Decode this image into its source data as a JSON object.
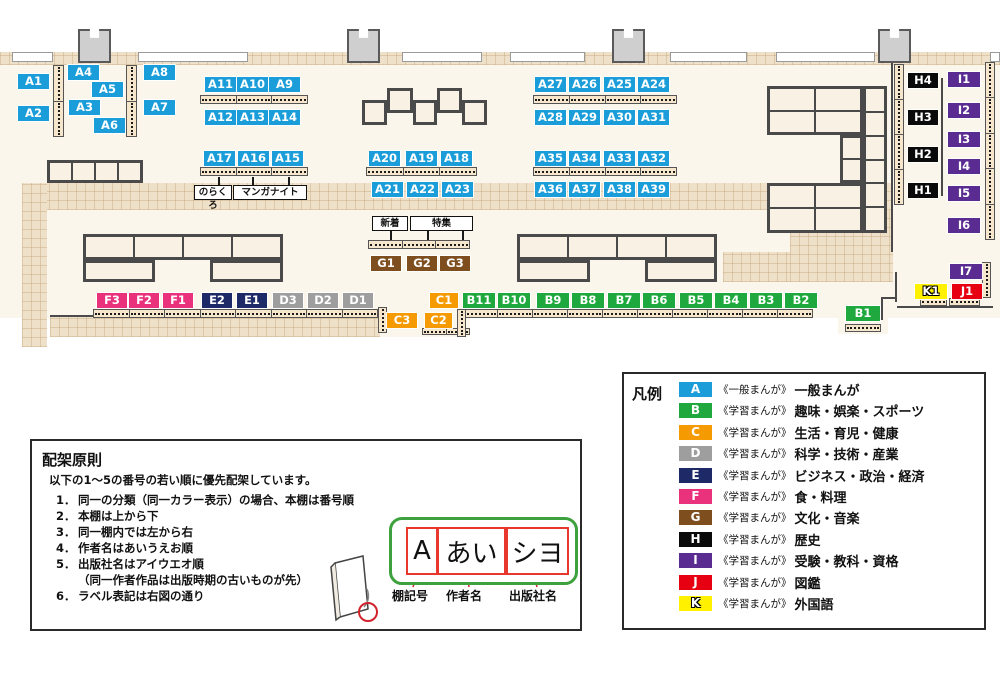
{
  "colors": {
    "A": "#1B9DD9",
    "B": "#1FA83D",
    "C": "#F59A00",
    "D": "#9E9E9F",
    "E": "#1E2A68",
    "F": "#E9317C",
    "G": "#7E4E1F",
    "H": "#0A0A0A",
    "I": "#5A2C91",
    "J": "#E60012",
    "K": "#FFF100"
  },
  "map": {
    "floor": [
      {
        "x": 0,
        "y": 52,
        "w": 1000,
        "h": 266
      },
      {
        "x": 378,
        "y": 318,
        "w": 92,
        "h": 19
      },
      {
        "x": 838,
        "y": 318,
        "w": 50,
        "h": 16
      }
    ],
    "bands": [
      {
        "x": 0,
        "y": 52,
        "w": 1000,
        "h": 13
      },
      {
        "x": 22,
        "y": 183,
        "w": 871,
        "h": 27
      },
      {
        "x": 22,
        "y": 183,
        "w": 25,
        "h": 164
      },
      {
        "x": 50,
        "y": 317,
        "w": 330,
        "h": 20
      },
      {
        "x": 790,
        "y": 210,
        "w": 103,
        "h": 72
      },
      {
        "x": 723,
        "y": 252,
        "w": 67,
        "h": 30
      }
    ],
    "windows": [
      {
        "x": 12,
        "w": 41
      },
      {
        "x": 138,
        "w": 110
      },
      {
        "x": 402,
        "w": 80
      },
      {
        "x": 510,
        "w": 75
      },
      {
        "x": 670,
        "w": 77
      },
      {
        "x": 776,
        "w": 99
      },
      {
        "x": 990,
        "w": 10
      }
    ],
    "pillars": [
      78,
      347,
      612,
      878
    ],
    "lines": [
      {
        "x": 891,
        "y": 62,
        "w": 2,
        "h": 190
      },
      {
        "x": 895,
        "y": 272,
        "w": 2,
        "h": 30
      },
      {
        "x": 881,
        "y": 297,
        "w": 16,
        "h": 2
      },
      {
        "x": 881,
        "y": 297,
        "w": 2,
        "h": 23
      },
      {
        "x": 897,
        "y": 306,
        "w": 96,
        "h": 2
      },
      {
        "x": 50,
        "y": 315,
        "w": 330,
        "h": 2
      },
      {
        "x": 941,
        "y": 78,
        "w": 2,
        "h": 118
      }
    ],
    "tables": [
      {
        "x": 47,
        "y": 160,
        "w": 96,
        "h": 23,
        "cols": 4
      },
      {
        "x": 362,
        "y": 100,
        "w": 25,
        "h": 25
      },
      {
        "x": 387,
        "y": 88,
        "w": 26,
        "h": 25
      },
      {
        "x": 413,
        "y": 100,
        "w": 24,
        "h": 25
      },
      {
        "x": 437,
        "y": 88,
        "w": 25,
        "h": 25
      },
      {
        "x": 462,
        "y": 100,
        "w": 25,
        "h": 25
      },
      {
        "x": 83,
        "y": 234,
        "w": 200,
        "h": 26,
        "cols": 4
      },
      {
        "x": 83,
        "y": 260,
        "w": 72,
        "h": 22
      },
      {
        "x": 210,
        "y": 260,
        "w": 73,
        "h": 22
      },
      {
        "x": 517,
        "y": 234,
        "w": 200,
        "h": 26,
        "cols": 4
      },
      {
        "x": 517,
        "y": 260,
        "w": 73,
        "h": 22
      },
      {
        "x": 645,
        "y": 260,
        "w": 72,
        "h": 22
      },
      {
        "x": 767,
        "y": 86,
        "w": 96,
        "h": 49,
        "cols": 2,
        "rows": 2
      },
      {
        "x": 863,
        "y": 86,
        "w": 24,
        "h": 147,
        "rows": 6
      },
      {
        "x": 840,
        "y": 135,
        "w": 23,
        "h": 48,
        "rows": 2
      },
      {
        "x": 767,
        "y": 183,
        "w": 96,
        "h": 50,
        "cols": 2,
        "rows": 2
      }
    ],
    "strips": [
      {
        "x": 200,
        "y": 95,
        "w": 108,
        "h": 9,
        "seg": 3
      },
      {
        "x": 200,
        "y": 167,
        "w": 108,
        "h": 9,
        "seg": 3
      },
      {
        "x": 366,
        "y": 167,
        "w": 111,
        "h": 9,
        "seg": 3
      },
      {
        "x": 533,
        "y": 95,
        "w": 144,
        "h": 9,
        "seg": 4
      },
      {
        "x": 533,
        "y": 167,
        "w": 144,
        "h": 9,
        "seg": 4
      },
      {
        "x": 368,
        "y": 240,
        "w": 102,
        "h": 9,
        "seg": 3
      },
      {
        "x": 93,
        "y": 309,
        "w": 285,
        "h": 9,
        "seg": 8
      },
      {
        "x": 462,
        "y": 309,
        "w": 351,
        "h": 9,
        "seg": 10
      },
      {
        "x": 845,
        "y": 324,
        "w": 36,
        "h": 8,
        "seg": 1
      },
      {
        "x": 920,
        "y": 298,
        "w": 27,
        "h": 8,
        "seg": 1
      },
      {
        "x": 949,
        "y": 298,
        "w": 31,
        "h": 8,
        "seg": 1
      },
      {
        "x": 422,
        "y": 328,
        "w": 48,
        "h": 7,
        "seg": 2
      },
      {
        "x": 53,
        "y": 65,
        "w": 11,
        "h": 72,
        "seg": 2,
        "o": "v"
      },
      {
        "x": 126,
        "y": 65,
        "w": 11,
        "h": 72,
        "seg": 2,
        "o": "v"
      },
      {
        "x": 894,
        "y": 64,
        "w": 10,
        "h": 141,
        "seg": 4,
        "o": "v"
      },
      {
        "x": 985,
        "y": 62,
        "w": 10,
        "h": 178,
        "seg": 5,
        "o": "v"
      },
      {
        "x": 982,
        "y": 262,
        "w": 9,
        "h": 36,
        "seg": 1,
        "o": "v"
      },
      {
        "x": 378,
        "y": 307,
        "w": 9,
        "h": 26,
        "seg": 1,
        "o": "v"
      },
      {
        "x": 457,
        "y": 309,
        "w": 9,
        "h": 28,
        "seg": 1,
        "o": "v"
      }
    ],
    "callouts": [
      {
        "text": "のらくろ",
        "x": 194,
        "y": 185,
        "w": 38,
        "tails": [
          {
            "x": 218,
            "y1": 177,
            "y2": 185
          }
        ]
      },
      {
        "text": "マンガナイト",
        "x": 233,
        "y": 185,
        "w": 74,
        "tails": [
          {
            "x": 252,
            "y1": 177,
            "y2": 185
          },
          {
            "x": 288,
            "y1": 177,
            "y2": 185
          }
        ]
      },
      {
        "text": "新着",
        "x": 372,
        "y": 216,
        "w": 36,
        "tails": [
          {
            "x": 390,
            "y1": 231,
            "y2": 240
          }
        ]
      },
      {
        "text": "特集",
        "x": 410,
        "y": 216,
        "w": 63,
        "tails": [
          {
            "x": 427,
            "y1": 231,
            "y2": 240
          },
          {
            "x": 462,
            "y1": 231,
            "y2": 240
          }
        ]
      }
    ],
    "labels": [
      {
        "c": "A1",
        "g": "A",
        "x": 18,
        "y": 74
      },
      {
        "c": "A2",
        "g": "A",
        "x": 18,
        "y": 106
      },
      {
        "c": "A4",
        "g": "A",
        "x": 68,
        "y": 65
      },
      {
        "c": "A5",
        "g": "A",
        "x": 92,
        "y": 82
      },
      {
        "c": "A3",
        "g": "A",
        "x": 69,
        "y": 100
      },
      {
        "c": "A6",
        "g": "A",
        "x": 94,
        "y": 118
      },
      {
        "c": "A8",
        "g": "A",
        "x": 144,
        "y": 65
      },
      {
        "c": "A7",
        "g": "A",
        "x": 144,
        "y": 100
      },
      {
        "c": "A11",
        "g": "A",
        "x": 205,
        "y": 77
      },
      {
        "c": "A10",
        "g": "A",
        "x": 237,
        "y": 77
      },
      {
        "c": "A9",
        "g": "A",
        "x": 269,
        "y": 77
      },
      {
        "c": "A12",
        "g": "A",
        "x": 205,
        "y": 110
      },
      {
        "c": "A13",
        "g": "A",
        "x": 237,
        "y": 110
      },
      {
        "c": "A14",
        "g": "A",
        "x": 269,
        "y": 110
      },
      {
        "c": "A17",
        "g": "A",
        "x": 204,
        "y": 151
      },
      {
        "c": "A16",
        "g": "A",
        "x": 238,
        "y": 151
      },
      {
        "c": "A15",
        "g": "A",
        "x": 272,
        "y": 151
      },
      {
        "c": "A20",
        "g": "A",
        "x": 369,
        "y": 151
      },
      {
        "c": "A19",
        "g": "A",
        "x": 406,
        "y": 151
      },
      {
        "c": "A18",
        "g": "A",
        "x": 441,
        "y": 151
      },
      {
        "c": "A21",
        "g": "A",
        "x": 372,
        "y": 182
      },
      {
        "c": "A22",
        "g": "A",
        "x": 407,
        "y": 182
      },
      {
        "c": "A23",
        "g": "A",
        "x": 442,
        "y": 182
      },
      {
        "c": "A27",
        "g": "A",
        "x": 535,
        "y": 77
      },
      {
        "c": "A26",
        "g": "A",
        "x": 569,
        "y": 77
      },
      {
        "c": "A25",
        "g": "A",
        "x": 604,
        "y": 77
      },
      {
        "c": "A24",
        "g": "A",
        "x": 638,
        "y": 77
      },
      {
        "c": "A28",
        "g": "A",
        "x": 535,
        "y": 110
      },
      {
        "c": "A29",
        "g": "A",
        "x": 569,
        "y": 110
      },
      {
        "c": "A30",
        "g": "A",
        "x": 604,
        "y": 110
      },
      {
        "c": "A31",
        "g": "A",
        "x": 638,
        "y": 110
      },
      {
        "c": "A35",
        "g": "A",
        "x": 535,
        "y": 151
      },
      {
        "c": "A34",
        "g": "A",
        "x": 569,
        "y": 151
      },
      {
        "c": "A33",
        "g": "A",
        "x": 604,
        "y": 151
      },
      {
        "c": "A32",
        "g": "A",
        "x": 638,
        "y": 151
      },
      {
        "c": "A36",
        "g": "A",
        "x": 535,
        "y": 182
      },
      {
        "c": "A37",
        "g": "A",
        "x": 569,
        "y": 182
      },
      {
        "c": "A38",
        "g": "A",
        "x": 604,
        "y": 182
      },
      {
        "c": "A39",
        "g": "A",
        "x": 638,
        "y": 182
      },
      {
        "c": "B11",
        "g": "B",
        "x": 463,
        "y": 293
      },
      {
        "c": "B10",
        "g": "B",
        "x": 498,
        "y": 293
      },
      {
        "c": "B9",
        "g": "B",
        "x": 537,
        "y": 293
      },
      {
        "c": "B8",
        "g": "B",
        "x": 572,
        "y": 293
      },
      {
        "c": "B7",
        "g": "B",
        "x": 608,
        "y": 293
      },
      {
        "c": "B6",
        "g": "B",
        "x": 643,
        "y": 293
      },
      {
        "c": "B5",
        "g": "B",
        "x": 680,
        "y": 293
      },
      {
        "c": "B4",
        "g": "B",
        "x": 715,
        "y": 293
      },
      {
        "c": "B3",
        "g": "B",
        "x": 750,
        "y": 293
      },
      {
        "c": "B2",
        "g": "B",
        "x": 785,
        "y": 293
      },
      {
        "c": "B1",
        "g": "B",
        "x": 846,
        "y": 306,
        "w": 34
      },
      {
        "c": "C1",
        "g": "C",
        "x": 430,
        "y": 293
      },
      {
        "c": "C3",
        "g": "C",
        "x": 387,
        "y": 313,
        "w": 30
      },
      {
        "c": "C2",
        "g": "C",
        "x": 425,
        "y": 313,
        "w": 27
      },
      {
        "c": "D3",
        "g": "D",
        "x": 273,
        "y": 293
      },
      {
        "c": "D2",
        "g": "D",
        "x": 308,
        "y": 293
      },
      {
        "c": "D1",
        "g": "D",
        "x": 343,
        "y": 293
      },
      {
        "c": "E2",
        "g": "E",
        "x": 202,
        "y": 293
      },
      {
        "c": "E1",
        "g": "E",
        "x": 237,
        "y": 293
      },
      {
        "c": "F3",
        "g": "F",
        "x": 97,
        "y": 293
      },
      {
        "c": "F2",
        "g": "F",
        "x": 129,
        "y": 293
      },
      {
        "c": "F1",
        "g": "F",
        "x": 163,
        "y": 293
      },
      {
        "c": "G1",
        "g": "G",
        "x": 371,
        "y": 256
      },
      {
        "c": "G2",
        "g": "G",
        "x": 407,
        "y": 256
      },
      {
        "c": "G3",
        "g": "G",
        "x": 440,
        "y": 256
      },
      {
        "c": "H4",
        "g": "H",
        "x": 908,
        "y": 73
      },
      {
        "c": "H3",
        "g": "H",
        "x": 908,
        "y": 110
      },
      {
        "c": "H2",
        "g": "H",
        "x": 908,
        "y": 147
      },
      {
        "c": "H1",
        "g": "H",
        "x": 908,
        "y": 183
      },
      {
        "c": "I1",
        "g": "I",
        "x": 948,
        "y": 72
      },
      {
        "c": "I2",
        "g": "I",
        "x": 948,
        "y": 103
      },
      {
        "c": "I3",
        "g": "I",
        "x": 948,
        "y": 132
      },
      {
        "c": "I4",
        "g": "I",
        "x": 948,
        "y": 159
      },
      {
        "c": "I5",
        "g": "I",
        "x": 948,
        "y": 186
      },
      {
        "c": "I6",
        "g": "I",
        "x": 948,
        "y": 218
      },
      {
        "c": "I7",
        "g": "I",
        "x": 950,
        "y": 264
      },
      {
        "c": "K1",
        "g": "K",
        "x": 915,
        "y": 284
      },
      {
        "c": "J1",
        "g": "J",
        "x": 952,
        "y": 284
      }
    ]
  },
  "legend": {
    "title": "凡例",
    "items": [
      {
        "letter": "A",
        "bracket": "《一般まんが》",
        "name": "一般まんが"
      },
      {
        "letter": "B",
        "bracket": "《学習まんが》",
        "name": "趣味・娯楽・スポーツ"
      },
      {
        "letter": "C",
        "bracket": "《学習まんが》",
        "name": "生活・育児・健康"
      },
      {
        "letter": "D",
        "bracket": "《学習まんが》",
        "name": "科学・技術・産業"
      },
      {
        "letter": "E",
        "bracket": "《学習まんが》",
        "name": "ビジネス・政治・経済"
      },
      {
        "letter": "F",
        "bracket": "《学習まんが》",
        "name": "食・料理"
      },
      {
        "letter": "G",
        "bracket": "《学習まんが》",
        "name": "文化・音楽"
      },
      {
        "letter": "H",
        "bracket": "《学習まんが》",
        "name": "歴史"
      },
      {
        "letter": "I",
        "bracket": "《学習まんが》",
        "name": "受験・教科・資格"
      },
      {
        "letter": "J",
        "bracket": "《学習まんが》",
        "name": "図鑑"
      },
      {
        "letter": "K",
        "bracket": "《学習まんが》",
        "name": "外国語"
      }
    ]
  },
  "principles": {
    "title": "配架原則",
    "intro": "以下の1～5の番号の若い順に優先配架しています。",
    "items": [
      {
        "n": "1．",
        "t": "同一の分類（同一カラー表示）の場合、本棚は番号順"
      },
      {
        "n": "2．",
        "t": "本棚は上から下"
      },
      {
        "n": "3．",
        "t": "同一棚内では左から右"
      },
      {
        "n": "4．",
        "t": "作者名はあいうえお順"
      },
      {
        "n": "5．",
        "t": "出版社名はアイウエオ順\n（同一作者作品は出版時期の古いものが先）"
      },
      {
        "n": "6．",
        "t": "ラベル表記は右図の通り"
      }
    ],
    "diagram": {
      "boxes": [
        "A",
        "あい",
        "シヨ"
      ],
      "captions": [
        "棚記号",
        "作者名",
        "出版社名"
      ]
    }
  }
}
